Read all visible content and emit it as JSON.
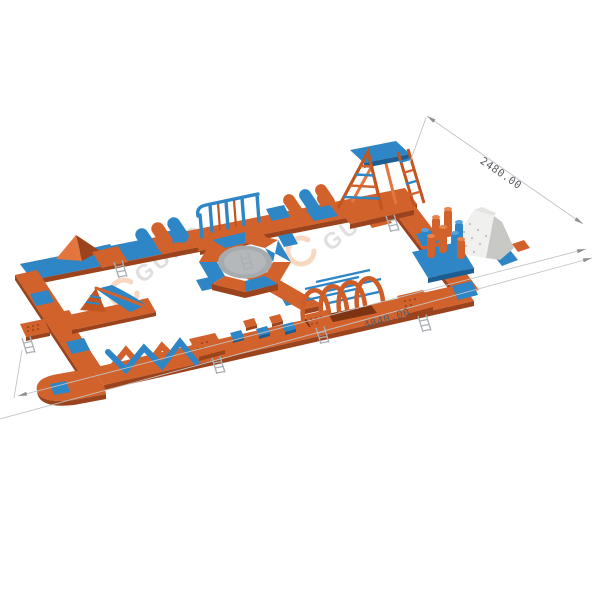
{
  "scene": {
    "type": "3d-product-render",
    "subject": "inflatable floating water park obstacle course",
    "background": "#FFFFFF"
  },
  "dimensions": {
    "length_label": "4840.00",
    "width_label": "2480.00"
  },
  "watermark": {
    "text": "GUNG",
    "logo": "open-ring-logo"
  },
  "colors": {
    "orange": "#D2622C",
    "orange_light": "#E2763D",
    "orange_dark": "#9A431D",
    "blue": "#2E86C6",
    "blue_light": "#55A4DC",
    "blue_dark": "#1D5E92",
    "iceberg_white": "#F0F0EE",
    "iceberg_shade": "#C8C8C5",
    "mesh_gray": "#A7ABAE",
    "dimension_line": "#C3C3C3",
    "dimension_text": "#585C61",
    "watermark_text": "#DADADA",
    "watermark_logo": "#F6CEB2"
  },
  "elements": [
    "perimeter-walkway-loop",
    "wedge-climb",
    "balance-cylinders",
    "rail-bridge",
    "roller-cylinders",
    "a-frame-climb-tower",
    "iceberg-climb-wall",
    "pillar-cluster",
    "arch-tunnel",
    "stepping-blocks",
    "x-beam-balance",
    "water-slide",
    "octagon-trampoline",
    "center-walkway",
    "connection-platforms",
    "boarding-ladders"
  ]
}
